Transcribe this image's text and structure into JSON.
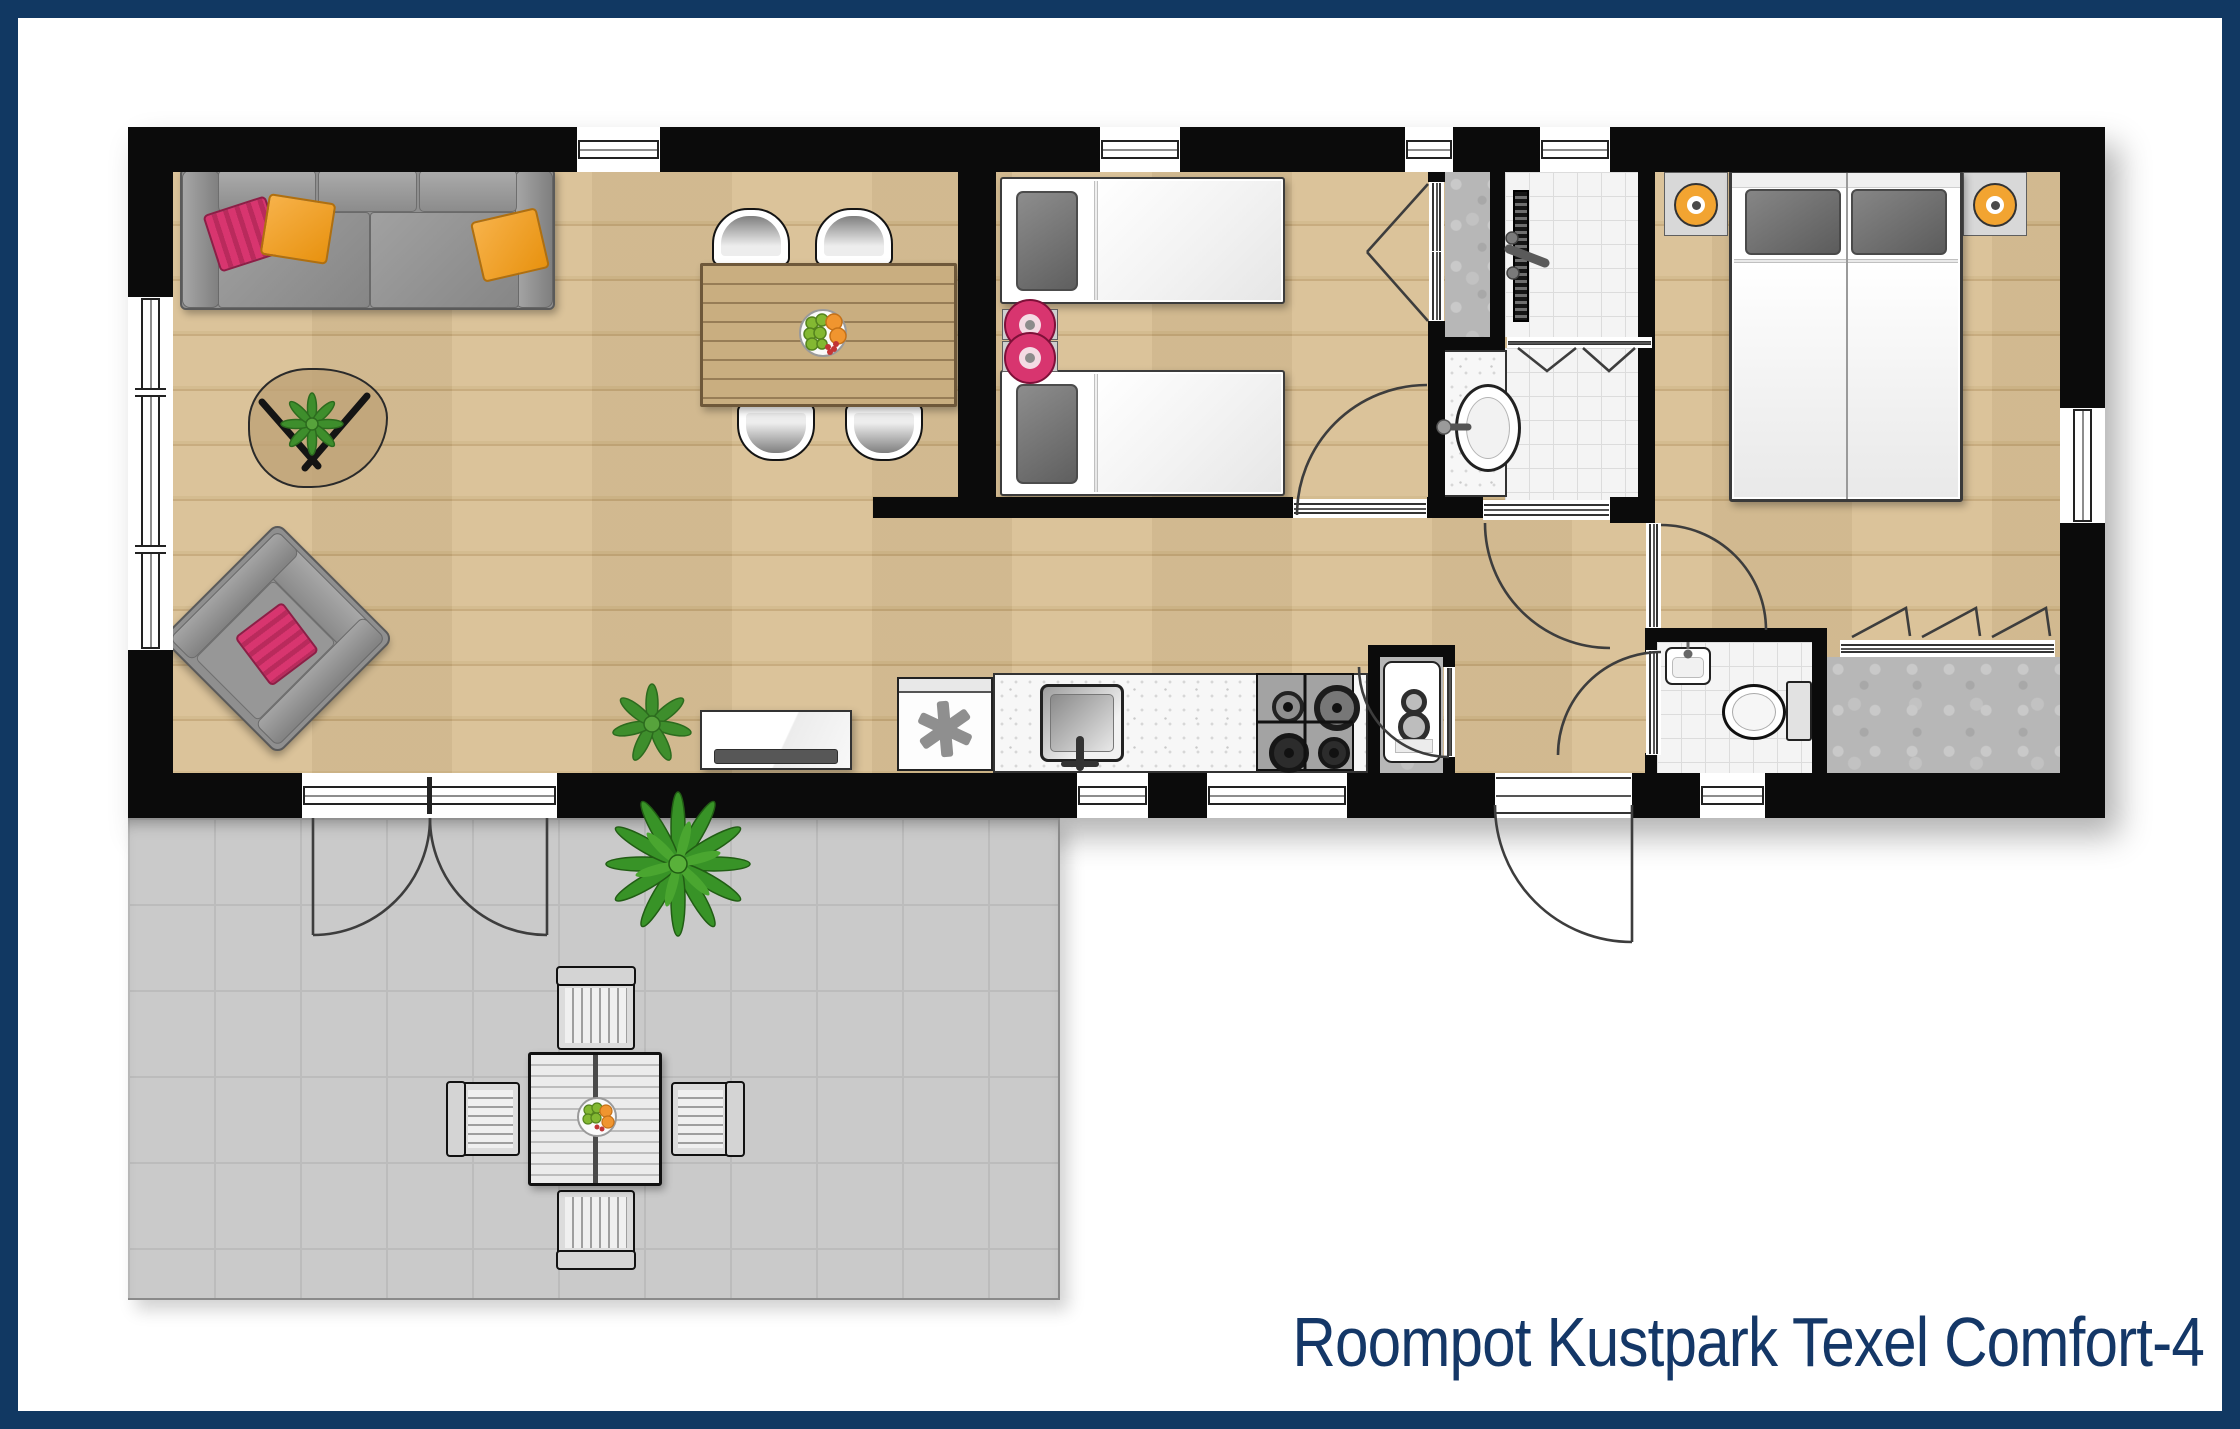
{
  "title": "Roompot Kustpark Texel Comfort-4",
  "colors": {
    "frame": "#113862",
    "title_text": "#143767",
    "walls": "#0b0b0b",
    "wood_floor": "#d9c095",
    "terrace": "#cacaca",
    "tile": "#f4f4f4",
    "accent_pink": "#d8356f",
    "accent_orange": "#f2a431",
    "plant_green": "#3e8e2c"
  },
  "rooms": [
    {
      "id": "living-dining",
      "furniture": [
        "sofa with pink and orange cushions",
        "organic coffee table with plant",
        "rotated armchair with pink cushion",
        "dining table with fruit bowl",
        "four shell dining chairs",
        "tv cabinet",
        "floor plant"
      ]
    },
    {
      "id": "kitchen",
      "furniture": [
        "dishwasher",
        "worktop with square sink",
        "four burner gas hob",
        "boiler cupboard"
      ]
    },
    {
      "id": "twin-bedroom",
      "furniture": [
        "two single beds",
        "nightstand with two pink stools",
        "built-in wardrobe with double doors"
      ]
    },
    {
      "id": "bathroom",
      "furniture": [
        "walk-in shower with linear drain",
        "bi-fold shower door",
        "oval washbasin on counter"
      ]
    },
    {
      "id": "toilet-room",
      "furniture": [
        "toilet with cistern",
        "hand basin"
      ]
    },
    {
      "id": "master-bedroom",
      "furniture": [
        "double bed with two pillows",
        "two nightstands with orange lamps",
        "built-in wardrobe with tri-fold doors"
      ]
    },
    {
      "id": "hallway",
      "furniture": [
        "doors to bathroom, toilet, master bedroom, back door"
      ]
    },
    {
      "id": "terrace",
      "furniture": [
        "slatted garden table with fruit bowl",
        "four slatted garden chairs",
        "palm plant"
      ]
    }
  ]
}
